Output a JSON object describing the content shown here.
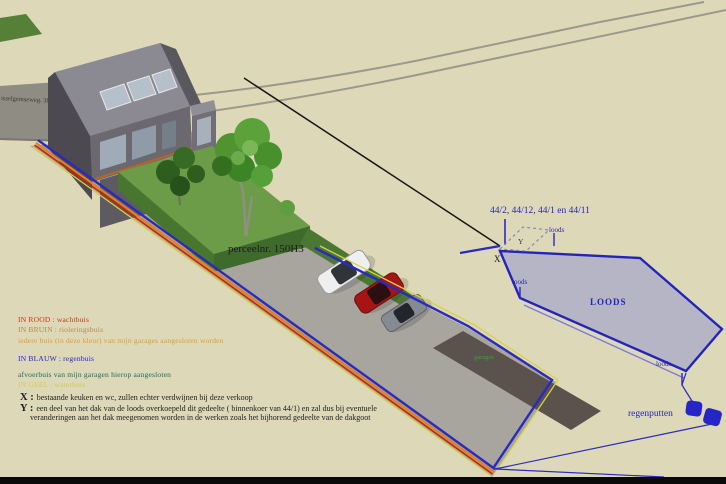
{
  "scene": {
    "street_label": "isselgemseweg. 38",
    "parcel_label": "perceelnr.  150H3",
    "parcel_numbers_label": "44/2,  44/12, 44/1 en 44/11",
    "marker_x": "X",
    "marker_y": "Y",
    "loods_label_main": "LOODS",
    "loods_label_top": "loods",
    "loods_label_left": "loods",
    "loods_label_bottom": "loods",
    "garages_label": "garages",
    "rainwells_label": "regenputten"
  },
  "legend": {
    "in_rood": "IN ROOD  :  wachtbuis",
    "in_bruin": "IN BRUIN  :  rioleringsbuis",
    "bruin_note": "iedere buis (in deze kleur) van mijn garages aangesloten worden",
    "in_blauw": "IN BLAUW  :   regenbuis",
    "blauw_note": "afvoerbuis  van mijn garagen hierop aangesloten",
    "in_geel": "IN GEEL  :  waterbuis"
  },
  "notes": {
    "x_prefix": "X :",
    "x_note": "bestaande keuken en wc, zullen echter verdwijnen bij deze verkoop",
    "y_prefix": "Y :",
    "y_note_line1": "een deel van het dak van de loods overkoepeld dit gedeelte ( binnenkoer van 44/1) en zal dus bij eventuele",
    "y_note_line2": "veranderingen aan het dak meegenomen worden in de werken zoals het bijhorend gedeelte van de dakgoot"
  },
  "colors": {
    "background": "#ddd9b8",
    "red_pipe": "#cc3311",
    "brown_pipe": "#e0821e",
    "blue_pipe": "#2a2ac0",
    "yellow_pipe": "#d6d24a",
    "loods_fill": "#b5b5c6",
    "green_label": "#2faa2f"
  }
}
